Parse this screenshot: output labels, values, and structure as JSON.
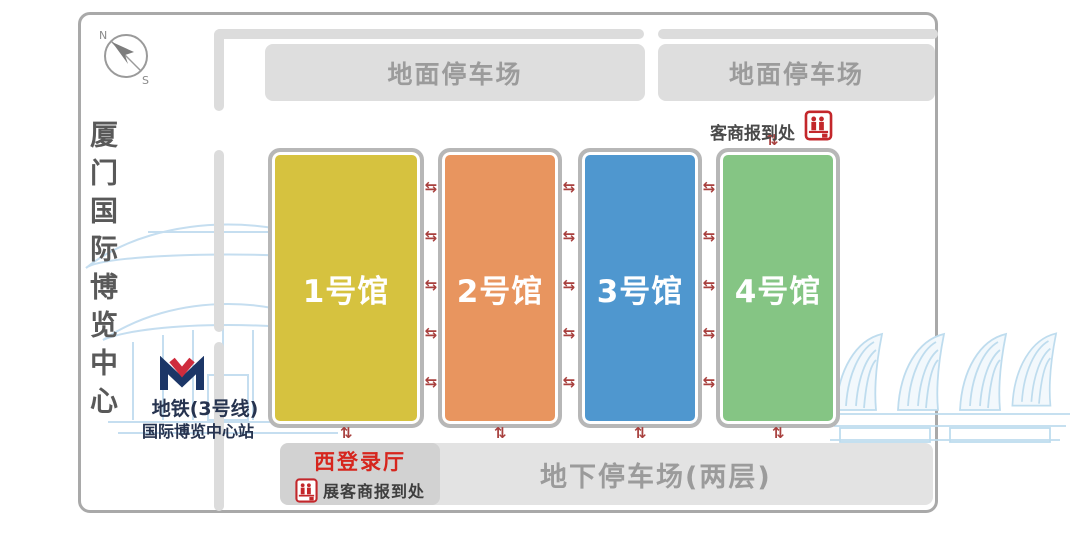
{
  "title": "厦门国际博览中心",
  "compass": {
    "north": "N",
    "south": "S"
  },
  "metro": {
    "line": "地铁(3号线)",
    "station": "国际博览中心站",
    "logo_navy": "#1c3667",
    "logo_red": "#cf2c3d"
  },
  "parking": {
    "ground": "地面停车场",
    "underground": "地下停车场(两层)"
  },
  "halls": [
    {
      "label": "1号馆",
      "color": "#d6c23f"
    },
    {
      "label": "2号馆",
      "color": "#e8955f"
    },
    {
      "label": "3号馆",
      "color": "#4f97cf"
    },
    {
      "label": "4号馆",
      "color": "#85c584"
    }
  ],
  "checkin_top": {
    "label": "客商报到处",
    "icon": "reception-desk-icon"
  },
  "west_hall": {
    "title": "西登录厅",
    "subtitle": "展客商报到处",
    "icon": "reception-desk-icon"
  },
  "arrows": {
    "horizontal": "⇆",
    "vertical": "⇅"
  },
  "colors": {
    "accent_red": "#d6251d",
    "arrow_red": "#a8403e",
    "road_gray": "#dcdcdc",
    "sketch_blue": "#c5def0"
  }
}
